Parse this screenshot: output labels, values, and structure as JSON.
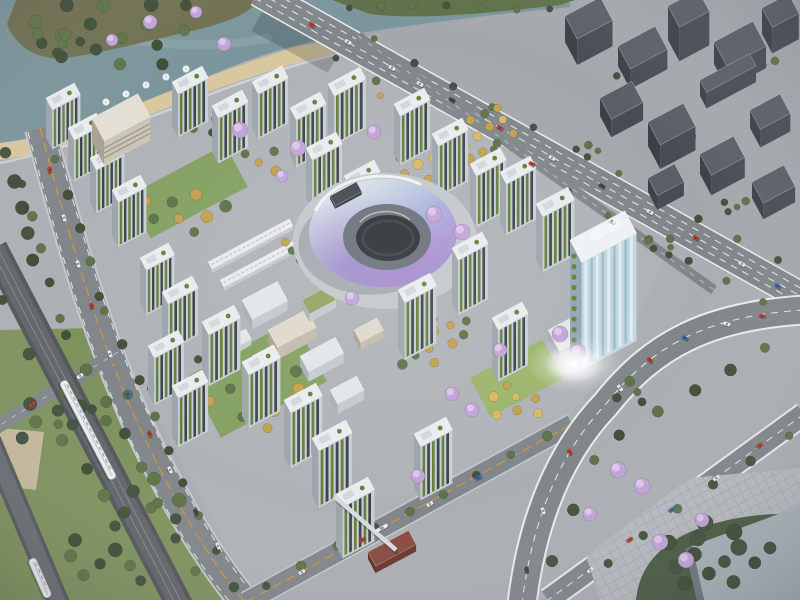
{
  "colors": {
    "base": "#ABAFB3",
    "water": "#7A959B",
    "waterLight": "#93ACAF",
    "parkGround": "#6F6F4F",
    "parkGreen": "#5E7048",
    "sand": "#D9C79F",
    "promenade": "#D5DADC",
    "westPave": "#ACB0B4",
    "lawnWest": "#7E925D",
    "tan": "#C6BA9C",
    "ctxGround": "#A4A8AD",
    "siteGround": "#AFB3B7",
    "plazaBR": "#B7BBC0",
    "massBR": "#4A5A42",
    "cornerBldg": "#A9B2B8",
    "cornerSide": "#6E7880",
    "roadMain": "#81868B",
    "roadEdgeSoft": "#C4C9CC",
    "laneWhite": "#E9EBED",
    "laneOrange": "#D2953C",
    "viaduct": "#53565A",
    "viaductTop": "#616569",
    "rail": "#888C90",
    "ramp": "#565A5E",
    "rampTop": "#6A6E72",
    "fbridge": "#D9DCDE",
    "lawn": "#84A061",
    "lawnBright": "#9CB56C",
    "treeDark": "#42513C",
    "treeMid": "#5E7349",
    "parkDark": "#3E4C36",
    "autumn": "#C2A04E",
    "autumnLight": "#D6BA60",
    "jacaranda": "#C1A3D6",
    "jacarandaLight": "#DCC6EA",
    "towerRoof": "#E9ECEF",
    "roofDetail": "#D2D7DA",
    "towerFace": "#C9CED3",
    "towerEnd": "#9DA4AB",
    "towerStripeGreen": "#64803E",
    "towerStripeDark": "#3B434C",
    "slabRoof": "#E3DFD4",
    "slabFace": "#CBC5B7",
    "slabEnd": "#A9A294",
    "glassFace": "#C3D7DF",
    "glassStripe": "#9FBECC",
    "glassLight": "#DFEDF2",
    "glassEnd": "#8FA7B3",
    "lrWhiteRoof": "#E3E6E9",
    "lrFace": "#C4C9CD",
    "lrEnd": "#A8AEB4",
    "lrBeigeRoof": "#DFD8CA",
    "lrBeigeFace": "#C2BBAC",
    "lrBeigeEnd": "#A79F90",
    "lrGreenRoof": "#8FA562",
    "redRoof": "#8A4A40",
    "redFace": "#6B362E",
    "redEnd": "#5C2F28",
    "stationRoof": "#E8EBED",
    "darkRoof": "#42474E",
    "darkFace": "#34383E",
    "darkEnd": "#2C3036",
    "blockTop": "#5A5F67",
    "blockSide": "#474C54",
    "blockDark": "#3B4047",
    "trainWhite": "#ECEEF0",
    "carRed": "#C23A2E",
    "carWhite": "#E9EBEC",
    "carBlue": "#3968B0",
    "carDark": "#3C4147",
    "donutPlaza": "#C3C7CB",
    "donutInnerWall": "#6A7078",
    "donutHole": "#2B2F34"
  },
  "scene": {
    "gridAngle": -28,
    "paths": {
      "water": "M0,0 L570,0 L570,7 C480,16 400,26 330,38 C285,46 240,62 195,82 C150,100 95,122 45,136 L0,143 Z",
      "waterStreak": "M40,18 C120,44 200,52 268,38",
      "peninsula": "M16,0 L258,0 C252,12 230,22 196,30 C150,40 100,54 64,58 C36,61 14,44 7,24 Z",
      "bankNE": "M332,0 L575,0 L560,5 C480,14 418,20 370,14 Z",
      "sand": "M0,143 C48,138 100,120 150,99 C200,79 248,62 295,47 L330,40 L338,52 C290,64 245,78 200,95 C152,114 100,134 52,152 L0,160 Z",
      "promenade": "M0,163 C60,151 130,125 200,98 C250,79 298,63 342,53",
      "westPavement": "M0,158 L46,146 C72,252 102,332 142,420 C177,502 207,556 242,604 L0,604 Z",
      "lawnWest": "M0,330 L98,328 L152,432 L208,522 L232,604 L0,604 Z",
      "tanPlaza": "M0,428 L44,432 L36,490 L0,486 Z",
      "contextGround": "M258,0 L800,0 L800,306 Z",
      "siteGround": "M62,148 L152,100 L298,46 L330,40 L425,92 L665,258 L632,332 L560,428 L452,482 L256,596 L224,542 L182,462 L138,382 L102,292 L74,202 Z",
      "plazaBR": "M586,556 L690,478 L800,468 L800,600 L600,600 Z",
      "treeMassBR": "M636,600 C640,560 668,540 700,528 C740,514 780,512 800,516 L800,600 Z",
      "cornerBldg": "M692,546 L800,506 L800,600 L704,600 Z",
      "cornerBldgSide": "M692,546 L704,600 L697,601 L685,549 Z",
      "bridgeShadow": "M260,16 L336,58",
      "arterial": "M258,-8 L804,298",
      "artLane1": "M254.6,-1.9 L800.6,304.1",
      "artLane2": "M261.4,-14.1 L807.4,291.9",
      "secondary": "M358,36 L714,290",
      "boulevard": "M40,128 C70,240 96,330 136,420 C176,506 210,560 246,604",
      "blvdLaneE": "M52,124 C82,236 108,326 148,414 C188,500 220,554 256,598",
      "blvdLaneW": "M28,132 C58,244 84,334 124,426 C164,512 199,566 235,608",
      "crossroad": "M118,352 L-8,430",
      "c2": "M246,602 L572,424",
      "curve": "M804,310 C706,316 652,346 606,404 C560,452 532,520 522,604",
      "c3": "M804,414 L548,600",
      "viaduct": "M-6,248 L180,606",
      "rail1": "M-8.7,249.3 L177.3,607.3",
      "rail2": "M-3.3,246.7 L182.7,604.7",
      "ramp2": "M-10,440 L60,606",
      "footbridge": "M334,496 L396,550"
    },
    "donut": {
      "cx": 383,
      "cy": 233,
      "rx": 74,
      "ry": 54,
      "innerRx": 44,
      "innerRy": 33,
      "holeRx": 32,
      "holeRy": 23,
      "plazaRx": 92,
      "plazaRy": 68,
      "highlight": "M316,210 A70,50 0 0 1 420,184",
      "rimLight": "M360,222 A30,21 0 0 1 410,220",
      "deck": [
        330,
        196,
        30,
        11,
        3
      ]
    },
    "towers": [
      [
        172,
        82,
        34,
        13,
        44
      ],
      [
        212,
        106,
        34,
        13,
        46
      ],
      [
        252,
        82,
        34,
        13,
        46
      ],
      [
        290,
        108,
        34,
        13,
        48
      ],
      [
        328,
        84,
        36,
        13,
        50
      ],
      [
        306,
        148,
        34,
        13,
        50
      ],
      [
        344,
        176,
        34,
        13,
        52
      ],
      [
        394,
        104,
        34,
        13,
        50
      ],
      [
        432,
        134,
        34,
        13,
        52
      ],
      [
        470,
        164,
        34,
        13,
        52
      ],
      [
        500,
        172,
        34,
        13,
        52
      ],
      [
        536,
        204,
        36,
        14,
        56
      ],
      [
        46,
        98,
        32,
        13,
        40
      ],
      [
        68,
        128,
        32,
        13,
        42
      ],
      [
        90,
        158,
        32,
        13,
        44
      ],
      [
        112,
        190,
        32,
        13,
        46
      ],
      [
        140,
        258,
        32,
        13,
        46
      ],
      [
        162,
        292,
        34,
        13,
        48
      ],
      [
        148,
        346,
        34,
        13,
        48
      ],
      [
        172,
        386,
        34,
        13,
        50
      ],
      [
        202,
        322,
        36,
        14,
        52
      ],
      [
        242,
        362,
        36,
        14,
        54
      ],
      [
        284,
        400,
        36,
        14,
        56
      ],
      [
        312,
        438,
        38,
        14,
        58
      ],
      [
        336,
        494,
        36,
        14,
        52
      ],
      [
        414,
        434,
        36,
        14,
        54
      ],
      [
        398,
        290,
        36,
        14,
        58
      ],
      [
        452,
        248,
        34,
        13,
        56
      ],
      [
        492,
        318,
        34,
        13,
        52
      ]
    ],
    "office": {
      "p": [
        570,
        240
      ],
      "l": 62,
      "w": 25,
      "h": 108
    },
    "slab": {
      "p": [
        92,
        118
      ],
      "l": 52,
      "w": 26,
      "h": 24
    },
    "lowRise": [
      [
        242,
        300,
        40,
        22,
        10,
        "white"
      ],
      [
        268,
        330,
        44,
        20,
        12,
        "beige"
      ],
      [
        300,
        356,
        40,
        18,
        10,
        "white"
      ],
      [
        252,
        356,
        24,
        14,
        8,
        "beige"
      ],
      [
        302,
        300,
        30,
        16,
        8,
        "green"
      ],
      [
        330,
        390,
        30,
        16,
        10,
        "white"
      ],
      [
        354,
        330,
        26,
        14,
        8,
        "beige"
      ],
      [
        228,
        338,
        20,
        12,
        6,
        "white"
      ],
      [
        548,
        330,
        50,
        24,
        8,
        "white"
      ],
      [
        368,
        552,
        46,
        16,
        7,
        "red"
      ],
      [
        208,
        262,
        92,
        8,
        4,
        "station"
      ],
      [
        220,
        280,
        92,
        8,
        4,
        "station"
      ]
    ],
    "blocks": [
      [
        565,
        16,
        40,
        26,
        26
      ],
      [
        618,
        46,
        42,
        26,
        20
      ],
      [
        668,
        6,
        34,
        24,
        34
      ],
      [
        714,
        42,
        44,
        28,
        22
      ],
      [
        762,
        8,
        30,
        22,
        26
      ],
      [
        600,
        98,
        36,
        24,
        18
      ],
      [
        648,
        122,
        40,
        26,
        24
      ],
      [
        700,
        154,
        38,
        24,
        20
      ],
      [
        750,
        110,
        34,
        22,
        18
      ],
      [
        752,
        182,
        36,
        24,
        16
      ],
      [
        648,
        178,
        30,
        20,
        14
      ],
      [
        700,
        80,
        56,
        14,
        16
      ]
    ],
    "lawns": [
      [
        128,
        196,
        110,
        48,
        "lawn"
      ],
      [
        188,
        376,
        120,
        70,
        "lawn"
      ],
      [
        470,
        378,
        82,
        44,
        "lawnBright"
      ]
    ],
    "treeRows": [
      [
        56,
        158,
        100,
        298,
        5,
        5,
        "treeDark",
        "treeMid"
      ],
      [
        106,
        312,
        232,
        586,
        9,
        5,
        "treeDark",
        "treeMid"
      ],
      [
        20,
        182,
        62,
        318,
        5,
        5,
        "treeMid",
        "treeDark"
      ],
      [
        68,
        334,
        196,
        570,
        8,
        6,
        "treeMid",
        "treeDark"
      ],
      [
        338,
        60,
        764,
        304,
        12,
        4,
        "treeMid",
        "treeDark"
      ],
      [
        372,
        40,
        780,
        262,
        11,
        4,
        "treeDark",
        "treeMid"
      ],
      [
        268,
        584,
        548,
        438,
        9,
        5,
        "treeMid",
        "treeDark"
      ],
      [
        766,
        346,
        620,
        436,
        5,
        6,
        "treeDark",
        "treeMid"
      ],
      [
        596,
        462,
        550,
        560,
        3,
        6,
        "treeDark",
        "treeMid"
      ],
      [
        196,
        360,
        60,
        426,
        5,
        5,
        "treeMid",
        "treeDark"
      ],
      [
        4,
        300,
        140,
        580,
        6,
        6,
        "treeDark",
        "parkDark"
      ],
      [
        6,
        152,
        34,
        262,
        5,
        7,
        "parkDark",
        "treeDark"
      ],
      [
        348,
        6,
        548,
        8,
        7,
        4,
        "treeMid",
        "treeDark"
      ],
      [
        788,
        434,
        606,
        562,
        6,
        5,
        "treeDark",
        "treeMid"
      ],
      [
        380,
        96,
        560,
        228,
        7,
        4,
        "treeMid",
        "autumn"
      ],
      [
        398,
        160,
        497,
        107,
        8,
        5,
        "autumn",
        "treeMid"
      ],
      [
        406,
        174,
        505,
        121,
        8,
        5,
        "autumnLight",
        "autumn"
      ],
      [
        414,
        188,
        513,
        135,
        8,
        5,
        "autumn",
        "treeMid"
      ]
    ],
    "clusters": [
      [
        115,
        30,
        85,
        16,
        7,
        "parkDark",
        "treeMid"
      ],
      [
        55,
        42,
        26,
        6,
        6,
        "parkDark",
        "treeMid"
      ],
      [
        182,
        212,
        46,
        8,
        6,
        "treeMid",
        "autumn"
      ],
      [
        262,
        396,
        60,
        11,
        6,
        "treeMid",
        "autumn"
      ],
      [
        512,
        402,
        34,
        7,
        5,
        "autumn",
        "autumnLight"
      ],
      [
        624,
        72,
        16,
        4,
        4,
        "treeDark",
        "treeMid"
      ],
      [
        684,
        142,
        18,
        5,
        4,
        "treeDark",
        "treeMid"
      ],
      [
        734,
        204,
        16,
        4,
        4,
        "treeDark",
        "treeMid"
      ],
      [
        592,
        152,
        14,
        3,
        4,
        "treeDark",
        "treeMid"
      ],
      [
        762,
        62,
        14,
        3,
        4,
        "treeDark",
        "treeMid"
      ],
      [
        664,
        246,
        20,
        5,
        4,
        "treeDark",
        "treeMid"
      ],
      [
        716,
        556,
        62,
        13,
        8,
        "parkDark",
        "treeDark"
      ],
      [
        60,
        420,
        55,
        8,
        7,
        "treeMid",
        "treeDark"
      ],
      [
        150,
        500,
        48,
        7,
        7,
        "treeDark",
        "treeMid"
      ],
      [
        92,
        558,
        42,
        6,
        7,
        "treeMid",
        "parkDark"
      ],
      [
        176,
        382,
        28,
        4,
        6,
        "treeDark",
        "treeMid"
      ],
      [
        218,
        128,
        26,
        4,
        5,
        "treeMid",
        "treeDark"
      ],
      [
        300,
        250,
        24,
        5,
        5,
        "autumn",
        "treeMid"
      ],
      [
        452,
        330,
        28,
        6,
        5,
        "treeMid",
        "autumn"
      ],
      [
        628,
        392,
        24,
        4,
        5,
        "treeDark",
        "treeMid"
      ],
      [
        268,
        160,
        30,
        5,
        5,
        "treeMid",
        "autumn"
      ],
      [
        420,
        360,
        24,
        4,
        5,
        "autumn",
        "treeMid"
      ]
    ],
    "jacarandas": [
      [
        150,
        22,
        7
      ],
      [
        196,
        12,
        6
      ],
      [
        224,
        44,
        7
      ],
      [
        112,
        40,
        6
      ],
      [
        240,
        130,
        8
      ],
      [
        298,
        148,
        8
      ],
      [
        374,
        132,
        7
      ],
      [
        434,
        214,
        8
      ],
      [
        462,
        232,
        8
      ],
      [
        560,
        334,
        8
      ],
      [
        578,
        352,
        8
      ],
      [
        500,
        350,
        7
      ],
      [
        452,
        394,
        7
      ],
      [
        472,
        410,
        7
      ],
      [
        352,
        298,
        7
      ],
      [
        282,
        176,
        6
      ],
      [
        418,
        476,
        7
      ],
      [
        618,
        470,
        8
      ],
      [
        642,
        486,
        8
      ],
      [
        660,
        542,
        8
      ],
      [
        686,
        560,
        8
      ],
      [
        590,
        514,
        7
      ],
      [
        702,
        520,
        7
      ]
    ],
    "umbrellas": [
      [
        126,
        94
      ],
      [
        146,
        85
      ],
      [
        166,
        77
      ],
      [
        186,
        69
      ],
      [
        106,
        102
      ]
    ],
    "cars": [
      [
        312,
        25,
        29,
        "carRed"
      ],
      [
        348,
        42,
        29,
        "carWhite"
      ],
      [
        392,
        68,
        29,
        "carWhite"
      ],
      [
        452,
        100,
        29,
        "carDark"
      ],
      [
        500,
        128,
        29,
        "carRed"
      ],
      [
        552,
        158,
        29,
        "carWhite"
      ],
      [
        602,
        186,
        29,
        "carDark"
      ],
      [
        650,
        212,
        29,
        "carWhite"
      ],
      [
        696,
        238,
        29,
        "carRed"
      ],
      [
        742,
        264,
        29,
        "carWhite"
      ],
      [
        778,
        286,
        29,
        "carBlue"
      ],
      [
        50,
        170,
        76,
        "carRed"
      ],
      [
        64,
        218,
        74,
        "carWhite"
      ],
      [
        78,
        264,
        72,
        "carWhite"
      ],
      [
        92,
        306,
        70,
        "carRed"
      ],
      [
        110,
        354,
        69,
        "carWhite"
      ],
      [
        128,
        394,
        68,
        "carBlue"
      ],
      [
        150,
        434,
        67,
        "carRed"
      ],
      [
        170,
        470,
        66,
        "carWhite"
      ],
      [
        196,
        512,
        65,
        "carDark"
      ],
      [
        218,
        546,
        65,
        "carWhite"
      ],
      [
        80,
        376,
        147,
        "carWhite"
      ],
      [
        32,
        404,
        147,
        "carRed"
      ],
      [
        302,
        572,
        -29,
        "carWhite"
      ],
      [
        362,
        540,
        -29,
        "carRed"
      ],
      [
        430,
        504,
        -29,
        "carWhite"
      ],
      [
        478,
        478,
        -29,
        "carBlue"
      ],
      [
        762,
        316,
        6,
        "carRed"
      ],
      [
        727,
        324,
        14,
        "carWhite"
      ],
      [
        685,
        338,
        28,
        "carBlue"
      ],
      [
        650,
        360,
        42,
        "carRed"
      ],
      [
        620,
        388,
        52,
        "carWhite"
      ],
      [
        570,
        452,
        62,
        "carRed"
      ],
      [
        543,
        511,
        72,
        "carWhite"
      ],
      [
        527,
        570,
        80,
        "carDark"
      ],
      [
        760,
        446,
        144,
        "carRed"
      ],
      [
        716,
        478,
        144,
        "carWhite"
      ],
      [
        672,
        510,
        144,
        "carBlue"
      ],
      [
        630,
        540,
        144,
        "carRed"
      ],
      [
        590,
        570,
        144,
        "carWhite"
      ],
      [
        420,
        84,
        29,
        "carWhite"
      ],
      [
        532,
        164,
        29,
        "carRed"
      ],
      [
        612,
        221,
        29,
        "carWhite"
      ]
    ],
    "bus": [
      382,
      528,
      -29
    ],
    "trains": [
      [
        88,
        430,
        62.6,
        110
      ],
      [
        40,
        578,
        66,
        42
      ]
    ],
    "glare": {
      "x": 574,
      "y": 364,
      "rx": 30,
      "ry": 19
    }
  }
}
